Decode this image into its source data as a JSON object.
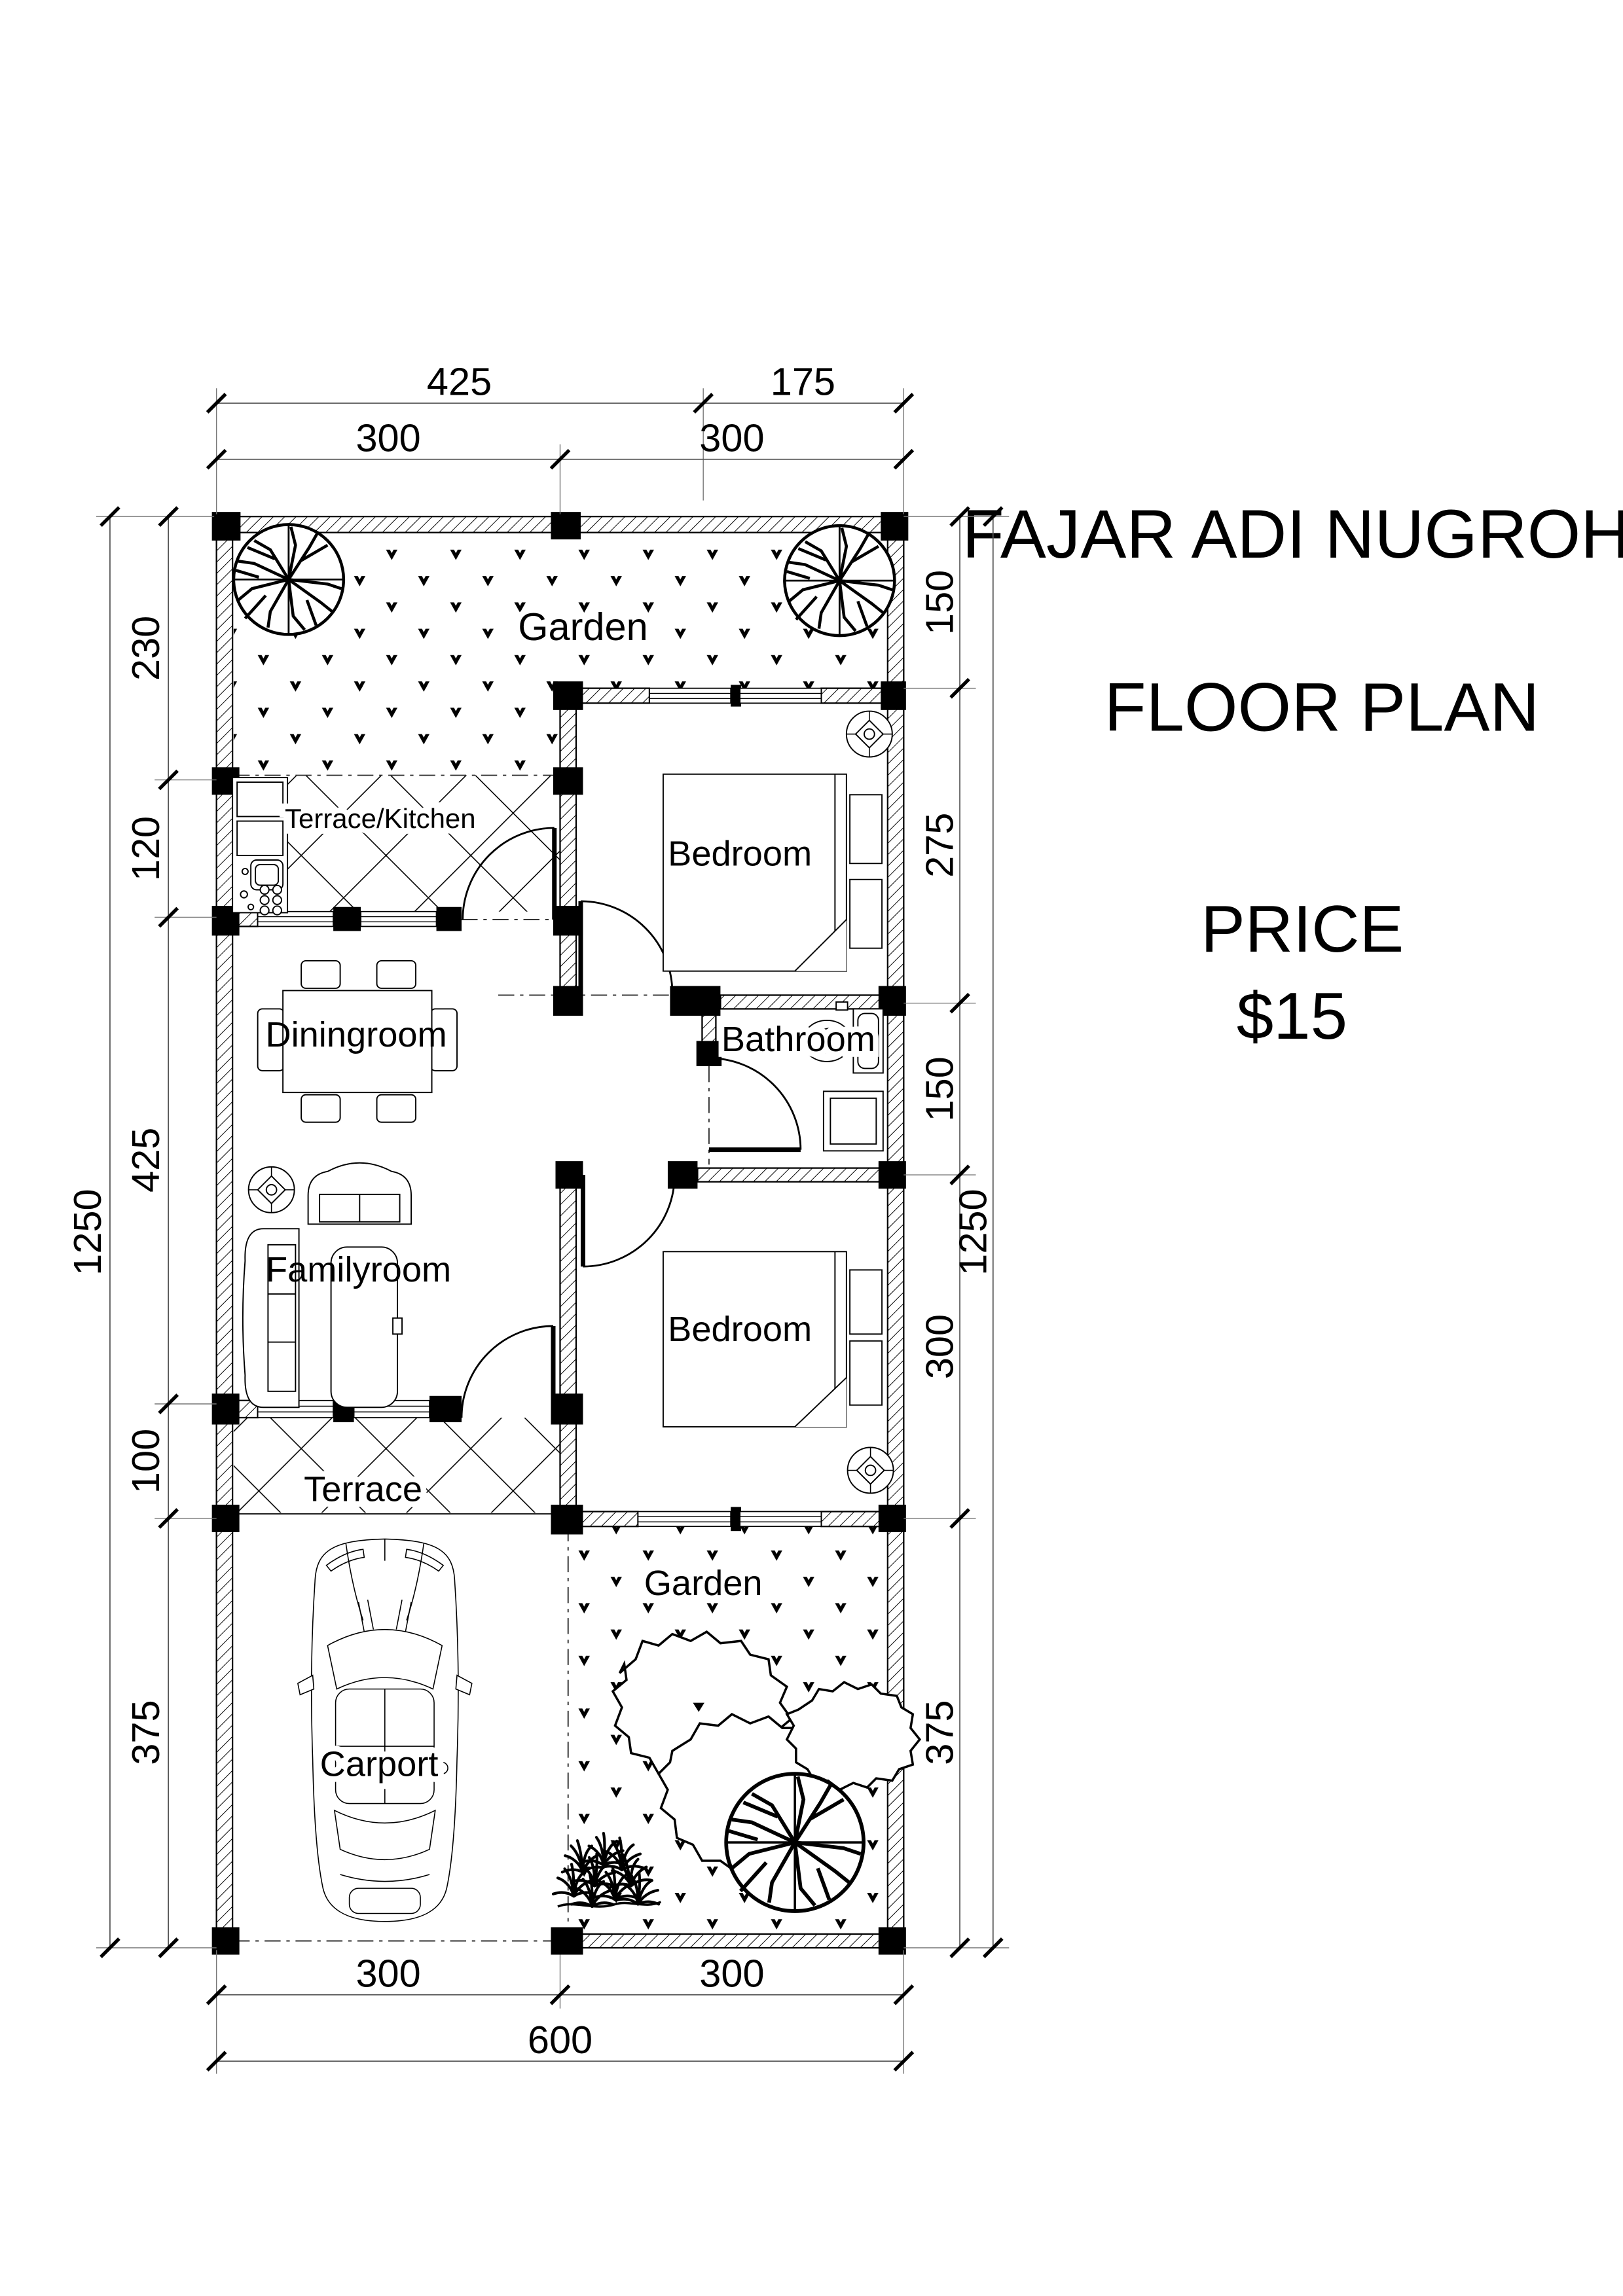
{
  "titles": {
    "client": "FAJAR ADI NUGROHO",
    "drawing": "FLOOR PLAN",
    "price_label": "PRICE",
    "price_value": "$15"
  },
  "rooms": {
    "garden_top": "Garden",
    "terrace_kitchen": "Terrace/Kitchen",
    "bedroom_top": "Bedroom",
    "diningroom": "Diningroom",
    "bathroom": "Bathroom",
    "familyroom": "Familyroom",
    "bedroom_bottom": "Bedroom",
    "terrace": "Terrace",
    "carport": "Carport",
    "garden_bottom": "Garden"
  },
  "dimensions": {
    "top_row1": [
      "425",
      "175"
    ],
    "top_row2": [
      "300",
      "300"
    ],
    "left_outer": "1250",
    "left_segments": [
      "230",
      "120",
      "425",
      "100",
      "375"
    ],
    "right_segments": [
      "150",
      "275",
      "150",
      "300",
      "375"
    ],
    "right_outer": "1250",
    "bottom_row1": [
      "300",
      "300"
    ],
    "bottom_total": "600"
  },
  "colors": {
    "ink": "#000000",
    "paper": "#ffffff"
  }
}
